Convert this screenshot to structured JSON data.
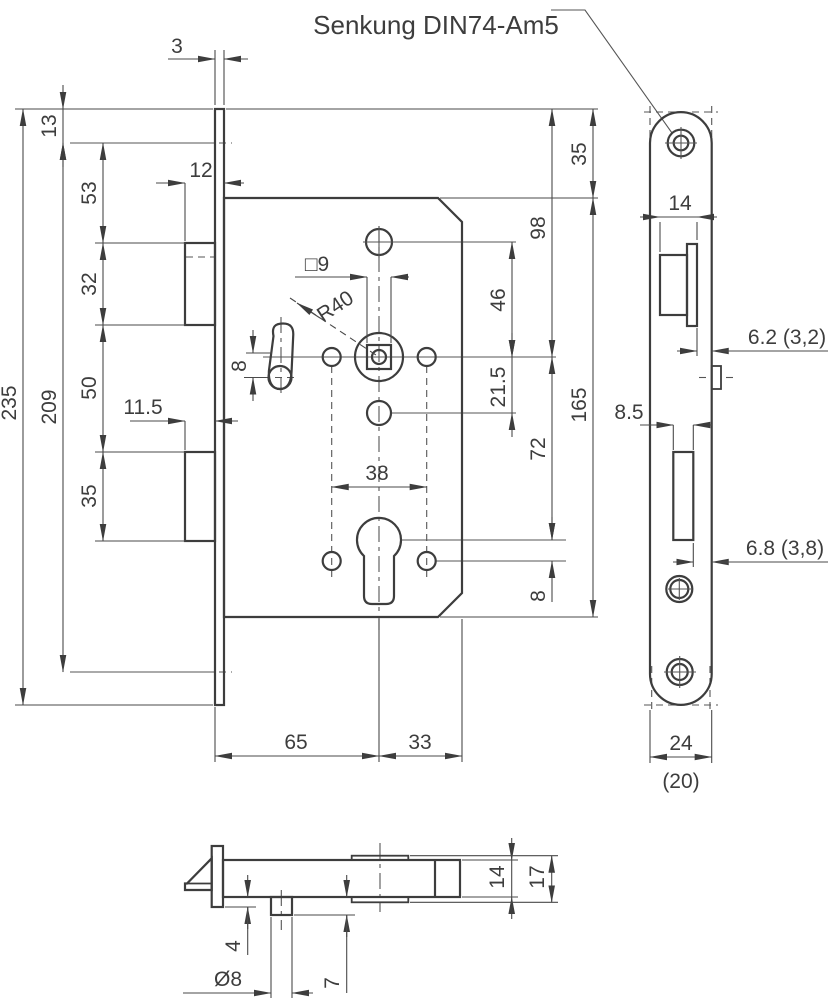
{
  "annotation": {
    "label": "Senkung DIN74-Am5"
  },
  "front_view": {
    "left": {
      "d3": "3",
      "d13": "13",
      "d53": "53",
      "d12": "12",
      "d32": "32",
      "d50": "50",
      "d8_slot": "8",
      "d209": "209",
      "d235": "235",
      "d11_5": "11.5",
      "d35": "35"
    },
    "center": {
      "sq9": "□9",
      "r40": "R40",
      "d38": "38",
      "d65": "65",
      "d33": "33"
    },
    "right": {
      "d35": "35",
      "d98": "98",
      "d46": "46",
      "d21_5": "21.5",
      "d165": "165",
      "d72": "72",
      "d8": "8"
    }
  },
  "side_view": {
    "d14": "14",
    "d6_2": "6.2 (3,2)",
    "d8_5": "8.5",
    "d6_8": "6.8 (3,8)",
    "d24": "24",
    "d20": "(20)"
  },
  "bottom_view": {
    "d14": "14",
    "d17": "17",
    "d4": "4",
    "d7": "7",
    "dia8": "Ø8"
  },
  "colors": {
    "line": "#3d3d3d",
    "background": "#ffffff"
  }
}
